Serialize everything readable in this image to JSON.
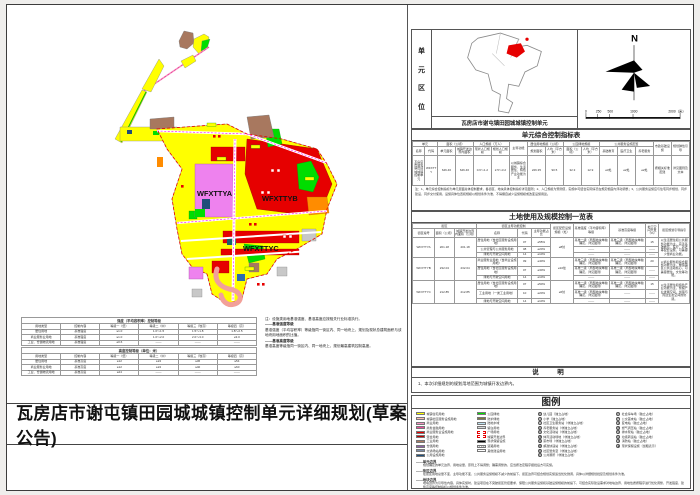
{
  "page": {
    "main_title": "瓦房店市谢屯镇田园城城镇控制单元详细规划(草案公告)"
  },
  "map": {
    "labels": [
      "WFXTTYA",
      "WFXTTYB",
      "WFXTTYC"
    ]
  },
  "location_panel": {
    "side_label": "单元区位",
    "caption": "瓦房店市谢屯镇田园城城镇控制单元",
    "north_label": "N",
    "scale_ticks": [
      "0",
      "250",
      "500",
      "1000",
      "2000（米）"
    ]
  },
  "intensity_tables": {
    "tableA": {
      "title": "强度（平均容积率）控制等级",
      "headers": [
        "用地类型",
        "控制内容",
        "等级一（低）",
        "等级二（中）",
        "等级三（较高）",
        "等级四（高）"
      ],
      "rows": [
        [
          "居住用地",
          "基准强度",
          "≤1.0",
          "1.0～1.5",
          "1.5～1.8",
          "1.8～2.5"
        ],
        [
          "商业服务业用地",
          "基准强度",
          "≤1.0",
          "1.0～2.0",
          "2.0～3.0",
          "≥3.0"
        ],
        [
          "工业、仓储物流用地",
          "基准强度",
          "≥0.6",
          "——",
          "——",
          "——"
        ]
      ]
    },
    "tableB": {
      "title": "高度控制等级（单位：米）",
      "headers": [
        "用地类型",
        "控制内容",
        "等级一（低）",
        "等级二（中）",
        "等级三（较高）",
        "等级四（高）"
      ],
      "rows": [
        [
          "居住用地",
          "基准高度",
          "≤12",
          "≤24",
          "≤36",
          "≤54"
        ],
        [
          "商业服务业用地",
          "基准高度",
          "≤12",
          "≤24",
          "≤40",
          "≤60"
        ],
        [
          "工业、仓储物流用地",
          "基准高度",
          "≤24",
          "——",
          "——",
          "——"
        ]
      ]
    },
    "note_lines": [
      "注：设施类用地基准强度、基准高度应按相关行业标准执行。",
      "——基准强度等级",
      "基准强度（平均容积率）等级指同一街区内、同一地块上，规划及现状总建筑面积与该地块用地面积的比值。",
      "——基准高度等级",
      "基准高度等级指同一街区内、同一地块上，规划最高建筑控制高度。"
    ]
  },
  "unit_table": {
    "title": "单元综合控制指标表",
    "groups": [
      {
        "label": "单元",
        "subs": [
          "名称",
          "代码"
        ]
      },
      {
        "label": "面积（公顷）",
        "subs": [
          "单元面积",
          "城镇开发边界内面积"
        ]
      },
      {
        "label": "人口规模（万人）",
        "subs": [
          "现状人口规模",
          "规划人口规模"
        ]
      },
      {
        "label": "主导功能",
        "subs": []
      },
      {
        "label": "居住用地规模（公顷）",
        "subs": [
          "规划面积",
          "人均（平方米）"
        ]
      },
      {
        "label": "公园绿地规模",
        "subs": [
          "面积（公顷）",
          "人均（平方米）"
        ]
      },
      {
        "label": "公共服务设施配置",
        "subs": [
          "基础教育",
          "医疗卫生",
          "养老服务"
        ]
      },
      {
        "label": "市政基础设施",
        "subs": []
      },
      {
        "label": "规划弹性引导",
        "subs": []
      }
    ],
    "row": [
      "瓦房店市谢屯镇田园城城镇控制单元",
      "WFXTTY",
      "646.46",
      "646.46",
      "0.6～1.2",
      "2.5～3.2",
      "以城镇综合服务、生活居住、特色产业功能为主",
      "226.35",
      "90.5",
      "32.3",
      "12.9",
      "≥3处",
      "≥2处",
      "≥2处",
      "按相关标准配建",
      "详见图则及文本"
    ],
    "footnote": "注：1、单元综合控制指标为单元层面总体控制要求，各街区、地块具体控制指标详见图则；2、人口规模为预测值，实施中可结合实际情况在规定幅度内浮动调整；3、公共服务设施应与住宅同步规划、同步建设、同步交付使用，设施具体位置和规模以规划条件为准，不得擅自减少设施规模或改变设施用途。"
  },
  "landuse_table": {
    "title": "土地使用及规模控制一览表",
    "header_groups": [
      {
        "label": "街区",
        "subs": [
          "街区编号",
          "面积（公顷）",
          "城镇开发边界内面积（公顷）"
        ]
      },
      {
        "label": "街区主导功能控制",
        "subs": [
          "名称",
          "代码",
          "主导功能占比"
        ]
      },
      {
        "label": "街区配套设施规模（处）",
        "subs": []
      },
      {
        "label": "基准强度（平均容积率）等级",
        "subs": []
      },
      {
        "label": "基准高度等级",
        "subs": []
      },
      {
        "label": "地下空间开发（%）",
        "subs": []
      },
      {
        "label": "街区规划引导指引",
        "subs": []
      }
    ],
    "groups": [
      {
        "id": "WFXTTYA",
        "area": "201.18",
        "boundary_area": "201.18",
        "facilities": "≥8处",
        "rows": [
          {
            "name": "居住用地（含社区服务设施用地）",
            "code": "07",
            "share": "≥55%",
            "intensity": "基准二级（局部地块单独确定，详见图则）",
            "height": "基准三级（局部地块单独确定，详见图则）",
            "underground": "15"
          },
          {
            "name": "公共管理与公共服务用地",
            "code": "08",
            "share": "≥20%",
            "intensity": "——",
            "height": "——",
            "underground": "——"
          },
          {
            "name": "绿地与开敞空间用地",
            "code": "14",
            "share": "≥10%",
            "intensity": "——",
            "height": "——",
            "underground": "——"
          }
        ],
        "guide": "以生活居住和公共服务功能为主，完善基础教育、医疗、养老等配套设施，可兼容少量商业功能。"
      },
      {
        "id": "WFXTTYB",
        "area": "232.04",
        "boundary_area": "232.04",
        "facilities": "≥10处",
        "rows": [
          {
            "name": "商业服务业用地（含商业设施用地）",
            "code": "09",
            "share": "≥40%",
            "intensity": "基准三级（局部地块单独确定，详见图则）",
            "height": "基准三级（局部地块单独确定，详见图则）",
            "underground": "20"
          },
          {
            "name": "居住用地（含社区服务设施用地）",
            "code": "07",
            "share": "≥30%",
            "intensity": "基准二级（局部地块单独确定，详见图则）",
            "height": "基准二级（局部地块单独确定，详见图则）",
            "underground": "——"
          },
          {
            "name": "绿地与开敞空间用地",
            "code": "14",
            "share": "≥10%",
            "intensity": "——",
            "height": "——",
            "underground": "——"
          }
        ],
        "guide": "以商业服务和综合服务功能为主，塑造镇区公共活动核心，可兼容居住、文化等功能。"
      },
      {
        "id": "WFXTTYC",
        "area": "212.85",
        "boundary_area": "212.85",
        "facilities": "≥6处",
        "rows": [
          {
            "name": "居住用地（含社区服务设施用地）",
            "code": "07",
            "share": "≥50%",
            "intensity": "基准二级（局部地块单独确定，详见图则）",
            "height": "基准二级（局部地块单独确定，详见图则）",
            "underground": "15"
          },
          {
            "name": "工业用地（一类工业用地）",
            "code": "10",
            "share": "≥20%",
            "intensity": "基准一级（局部地块单独确定，详见图则）",
            "height": "——",
            "underground": "——"
          },
          {
            "name": "绿地与开敞空间用地",
            "code": "14",
            "share": "≥10%",
            "intensity": "——",
            "height": "——",
            "underground": "——"
          }
        ],
        "guide": "以生活居住和特色产业功能为主，预留产业发展空间，加强与周边生态空间的协调。"
      }
    ]
  },
  "notes": {
    "title": "说　明",
    "items": [
      "1、本次详细规划的规划用地范围为城镇开发边界内。"
    ]
  },
  "legend": {
    "title": "图例",
    "columns": [
      [
        {
          "color": "#FFFF00",
          "label": "城镇住宅用地"
        },
        {
          "color": "#FBBFB6",
          "label": "城镇社区服务设施用地"
        },
        {
          "color": "#F591C2",
          "label": "商业用地"
        },
        {
          "color": "#ED4C9C",
          "label": "商务金融用地"
        },
        {
          "color": "#E60000",
          "label": "商业服务业设施用地"
        },
        {
          "color": "#C00000",
          "label": "混合用地"
        },
        {
          "color": "#A8785F",
          "label": "工业用地"
        },
        {
          "color": "#8F62A8",
          "label": "仓储用地"
        },
        {
          "color": "#7A8BA6",
          "label": "交通场站用地"
        },
        {
          "color": "#1F4E79",
          "label": "公用设施用地"
        }
      ],
      [
        {
          "color": "#00DD00",
          "label": "公园绿地"
        },
        {
          "color": "#7C7A3A",
          "label": "防护绿地"
        },
        {
          "color": "#BFE3F2",
          "label": "陆地水域"
        },
        {
          "color": "#D9D9D9",
          "label": "留白用地"
        },
        {
          "color": "#FFFFFF",
          "style": "dash-red",
          "label": "广场用地"
        },
        {
          "color": "#FFFFFF",
          "style": "dash-red",
          "label": "城镇开发边界"
        },
        {
          "color": "#000000",
          "style": "black",
          "label": "现状保留设施"
        },
        {
          "color": "#FFFFFF",
          "style": "hatch",
          "label": "道路用地"
        },
        {
          "color": "#FFFFFF",
          "label": "其他建设用地"
        }
      ],
      [
        {
          "sym": "幼",
          "label": "幼儿园（独立占地）"
        },
        {
          "sym": "小",
          "label": "小学（独立占地）"
        },
        {
          "sym": "卫",
          "label": "社区卫生服务站（非独立占地）"
        },
        {
          "sym": "养",
          "label": "养老服务站（非独立占地）"
        },
        {
          "sym": "文",
          "label": "文化活动站（非独立占地）"
        },
        {
          "sym": "体",
          "label": "体育活动场地（非独立占地）"
        },
        {
          "sym": "菜",
          "label": "菜市场（非独立占地）"
        },
        {
          "sym": "邮",
          "label": "邮政快递站（非独立占地）"
        },
        {
          "sym": "警",
          "label": "社区警务室（非独立占地）"
        },
        {
          "sym": "公",
          "label": "公共厕所（非独立占地）"
        }
      ],
      [
        {
          "sym": "P",
          "label": "社会停车场（独立占地）"
        },
        {
          "sym": "巴",
          "label": "公交首末站（独立占地）"
        },
        {
          "sym": "变",
          "label": "变电站（独立占地）"
        },
        {
          "sym": "燃",
          "label": "燃气调压站（独立占地）"
        },
        {
          "sym": "泵",
          "label": "排水泵站（独立占地）"
        },
        {
          "sym": "环",
          "label": "垃圾转运站（独立占地）"
        },
        {
          "sym": "消",
          "label": "消防站（独立占地）"
        },
        {
          "sym": "■",
          "label": "现状保留设施（加粗表示）"
        }
      ]
    ],
    "line_items": [
      {
        "name": "——单元边界",
        "desc": "规划确定的单元边界、用地总量，原则上不得调整；确需调整的，应当按法定程序报批后方可实施。"
      },
      {
        "name": "——街区边界",
        "desc": "在街区用地总量不变、主导功能不变、公共服务设施规模不减少的前提下，街区边界可结合规划实施适当优化微调，具体以详细规划批复及规划条件为准。"
      },
      {
        "name": "——地块边界",
        "desc": "地块边界为引导性内容，具体实施时，建设项目在不突破街区管控要求、保障公共服务设施和基础设施规模的前提下，可结合实际建设需求对地块边界、用地性质按程序进行优化调整，开发强度、建筑高度等控制指标以规划条件为准。"
      }
    ]
  }
}
